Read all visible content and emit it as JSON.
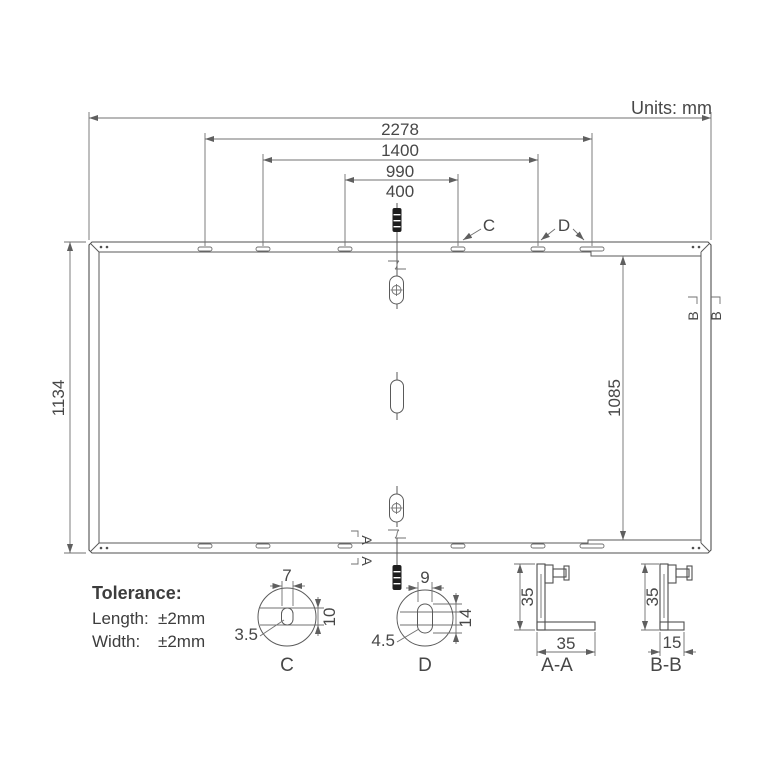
{
  "units_label": "Units: mm",
  "panel": {
    "dim_overall_width": "2278",
    "dim_mount_1400": "1400",
    "dim_mount_990": "990",
    "dim_mount_400": "400",
    "dim_height": "1134",
    "dim_mount_height": "1085",
    "callout_c": "C",
    "callout_d": "D",
    "section_a": "A",
    "section_b": "B"
  },
  "tolerance": {
    "title": "Tolerance:",
    "length_label": "Length:",
    "length_value": "±2mm",
    "width_label": "Width:",
    "width_value": "±2mm"
  },
  "details": {
    "c": {
      "slot_width": "7",
      "slot_height": "10",
      "slot_radius": "3.5",
      "label": "C"
    },
    "d": {
      "slot_width": "9",
      "slot_height": "14",
      "slot_radius": "4.5",
      "label": "D"
    },
    "aa": {
      "frame_height": "35",
      "frame_width": "35",
      "label": "A-A"
    },
    "bb": {
      "frame_height": "35",
      "frame_width": "15",
      "label": "B-B"
    }
  },
  "colors": {
    "line": "#4f4f4f",
    "dimension_line": "#707070",
    "text": "#474747",
    "connector_fill": "#1e1e1e",
    "background": "#ffffff"
  }
}
